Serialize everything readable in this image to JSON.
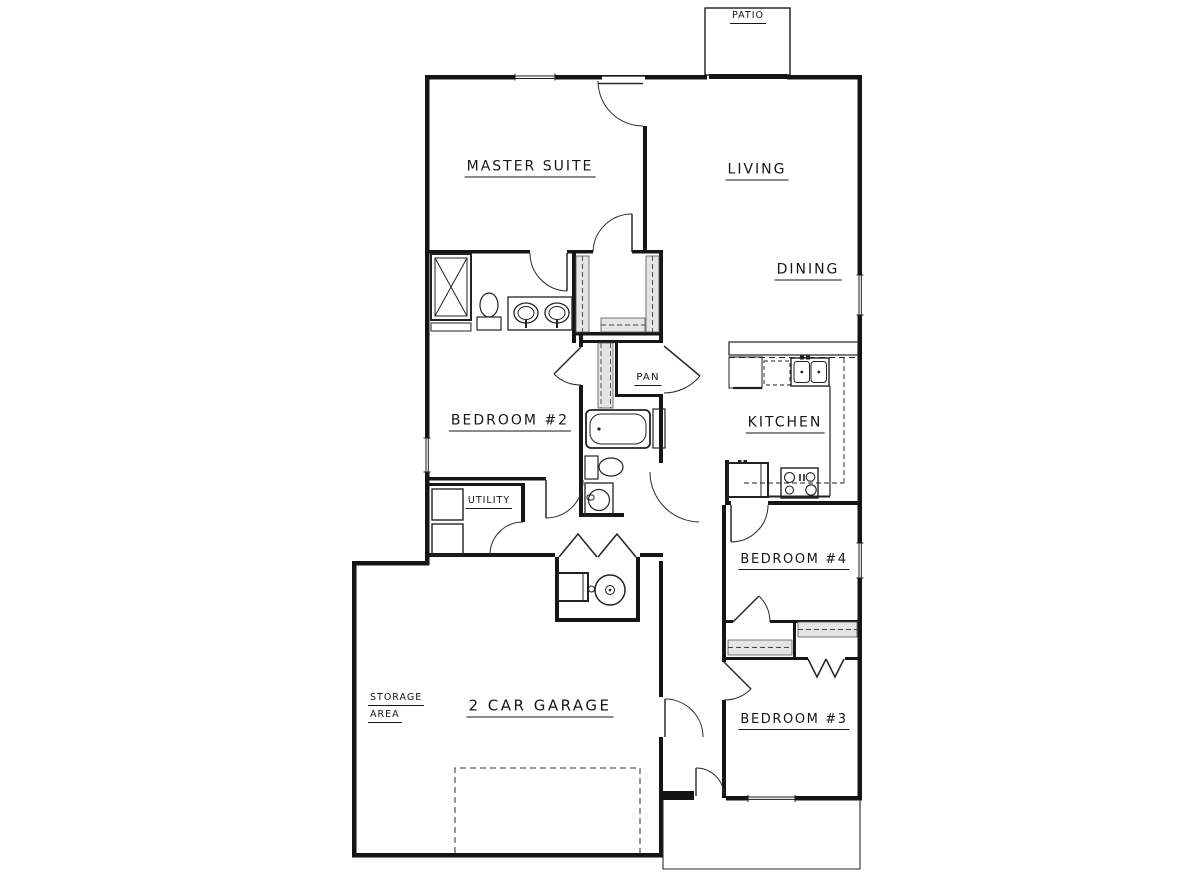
{
  "plan": {
    "title": "single-story house floor plan",
    "labels": {
      "patio": "PATIO",
      "master_suite": "MASTER SUITE",
      "living": "LIVING",
      "dining": "DINING",
      "pantry": "PAN",
      "bedroom2": "BEDROOM #2",
      "kitchen": "KITCHEN",
      "utility": "UTILITY",
      "bedroom4": "BEDROOM #4",
      "bedroom3": "BEDROOM #3",
      "storage_line1": "STORAGE",
      "storage_line2": "AREA",
      "garage": "2 CAR GARAGE"
    },
    "colors": {
      "background": "#ffffff",
      "walls": "#141414",
      "linework": "#222222",
      "closet_shelf_fill": "#e4e4e4"
    },
    "fixtures": [
      "shower",
      "master-toilet",
      "double-vanity-sinks",
      "walk-in-closet-shelving",
      "bathtub",
      "hall-toilet",
      "vanity-sink",
      "linen-shelf",
      "breakfast-bar",
      "kitchen-double-sink",
      "dishwasher-dashed",
      "range-cooktop",
      "refrigerator",
      "washer",
      "dryer",
      "furnace",
      "water-heater",
      "garage-door-dashed",
      "front-porch",
      "door-swings",
      "windows"
    ]
  }
}
